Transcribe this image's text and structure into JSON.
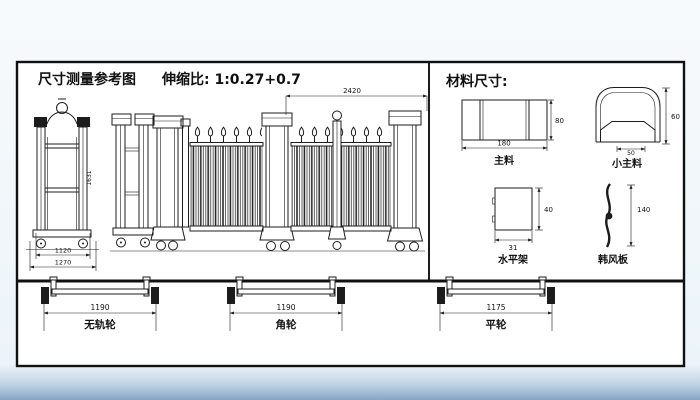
{
  "titles": {
    "measure_title": "尺寸测量参考图",
    "ratio": "伸缩比: 1:0.27+0.7",
    "material_title": "材料尺寸:"
  },
  "gate_dims": {
    "top_width": "2420",
    "unit_width_inner": "1120",
    "unit_width_outer": "1270",
    "unit_height": "1631"
  },
  "profiles": {
    "main": {
      "label": "主料",
      "width": "180",
      "height": "80"
    },
    "small_main": {
      "label": "小主料",
      "width": "50",
      "height": "60"
    },
    "horizontal": {
      "label": "水平架",
      "width": "31",
      "height": "40"
    },
    "curved": {
      "label": "韩风板",
      "height": "140"
    }
  },
  "wheels": [
    {
      "label": "无轨轮",
      "length": "1190"
    },
    {
      "label": "角轮",
      "length": "1190"
    },
    {
      "label": "平轮",
      "length": "1175"
    }
  ],
  "colors": {
    "line": "#1c1c1c",
    "page": "#ffffff",
    "bottom_fade": "#84a4c4"
  }
}
